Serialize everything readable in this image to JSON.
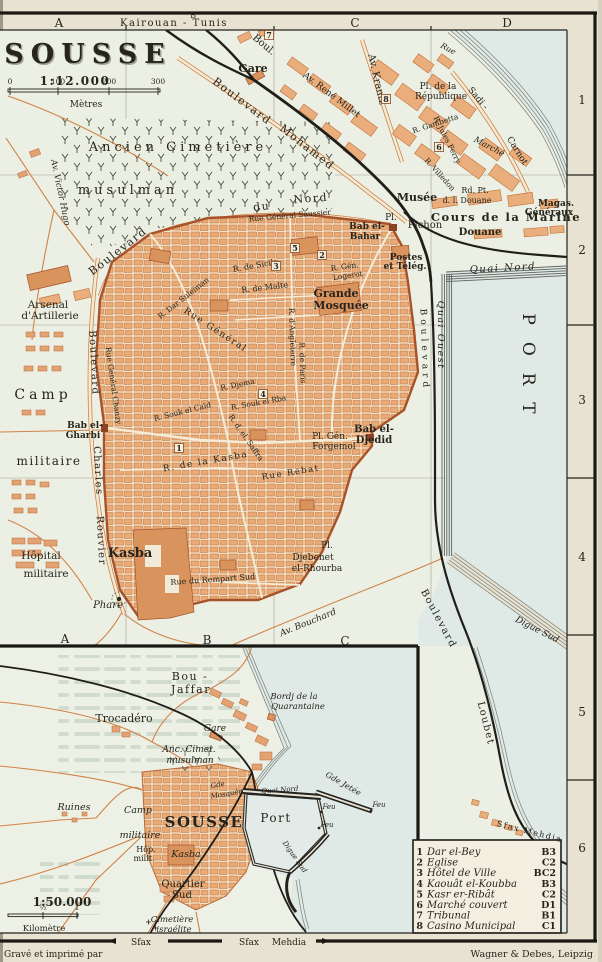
{
  "colors": {
    "paper": "#e7e2d1",
    "land": "#ecefe3",
    "water": "#dfe9e6",
    "town_salmon": "#e9ae7c",
    "wall_orange": "#a8522a",
    "ink": "#27241c",
    "bleed": "#9cb6a7"
  },
  "frame": {
    "destinations": {
      "t": "Kairouan - Tunis",
      "x": 174,
      "y": 26,
      "s": 10,
      "c": "sp1"
    },
    "cols_top": [
      {
        "t": "A",
        "x": 59,
        "y": 27,
        "s": 12
      },
      {
        "t": "B",
        "x": 193,
        "y": 18,
        "s": 8
      },
      {
        "t": "C",
        "x": 355,
        "y": 27,
        "s": 12
      },
      {
        "t": "D",
        "x": 507,
        "y": 27,
        "s": 12
      }
    ],
    "cols_bottom": [
      {
        "t": "A",
        "x": 65,
        "y": 643,
        "s": 12
      },
      {
        "t": "B",
        "x": 207,
        "y": 644,
        "s": 12
      },
      {
        "t": "C",
        "x": 345,
        "y": 645,
        "s": 12
      }
    ],
    "rows_right": [
      {
        "t": "1",
        "x": 582,
        "y": 104,
        "s": 12
      },
      {
        "t": "2",
        "x": 582,
        "y": 254,
        "s": 12
      },
      {
        "t": "3",
        "x": 582,
        "y": 404,
        "s": 12
      },
      {
        "t": "4",
        "x": 582,
        "y": 561,
        "s": 12
      },
      {
        "t": "5",
        "x": 582,
        "y": 716,
        "s": 12
      },
      {
        "t": "6",
        "x": 582,
        "y": 852,
        "s": 12
      }
    ]
  },
  "imprint": {
    "left": {
      "t": "Gravé et imprimé par",
      "x": 4,
      "y": 957,
      "s": 9,
      "a": "start"
    },
    "right": {
      "t": "Wagner & Debes, Leipzig",
      "x": 593,
      "y": 957,
      "s": 9.5,
      "a": "end"
    }
  },
  "bottom_edge": [
    {
      "t": "Sfax",
      "x": 141,
      "y": 945,
      "s": 9
    },
    {
      "t": "Sfax",
      "x": 249,
      "y": 945,
      "s": 9
    },
    {
      "t": "Mehdia",
      "x": 289,
      "y": 945,
      "s": 9
    }
  ],
  "main_map": {
    "scale_bar": {
      "x1": 8,
      "x2": 160,
      "y": 89,
      "unit": "Mètres",
      "ticks": [
        {
          "t": "0",
          "x": 10
        },
        {
          "t": "100",
          "x": 58
        },
        {
          "t": "200",
          "x": 109
        },
        {
          "t": "300",
          "x": 158
        }
      ]
    },
    "markers": [
      {
        "n": "1",
        "x": 179,
        "y": 450
      },
      {
        "n": "2",
        "x": 322,
        "y": 257
      },
      {
        "n": "3",
        "x": 276,
        "y": 268
      },
      {
        "n": "4",
        "x": 263,
        "y": 396
      },
      {
        "n": "5",
        "x": 295,
        "y": 250
      },
      {
        "n": "6",
        "x": 439,
        "y": 149
      },
      {
        "n": "7",
        "x": 269,
        "y": 37
      },
      {
        "n": "8",
        "x": 386,
        "y": 101
      }
    ],
    "labels": [
      {
        "t": "SOUSSE",
        "x": 88,
        "y": 63,
        "s": 27,
        "c": "sans ttl sh"
      },
      {
        "t": "1:12.000",
        "x": 75,
        "y": 85,
        "s": 12,
        "c": "sans b sp1"
      },
      {
        "t": "Mètres",
        "x": 86,
        "y": 107,
        "s": 9
      },
      {
        "t": "Boul.",
        "x": 262,
        "y": 47,
        "r": 40,
        "s": 10
      },
      {
        "t": "Gare",
        "x": 253,
        "y": 72,
        "s": 11,
        "c": "b"
      },
      {
        "t": "Boulevard",
        "x": 240,
        "y": 104,
        "r": 37,
        "s": 11,
        "c": "sp1"
      },
      {
        "t": "Mohamed",
        "x": 305,
        "y": 150,
        "r": 38,
        "s": 11,
        "c": "sp1"
      },
      {
        "t": "Av. René Millet",
        "x": 330,
        "y": 97,
        "r": 37,
        "s": 9
      },
      {
        "t": "Av. Krantz",
        "x": 374,
        "y": 80,
        "r": 77,
        "s": 10
      },
      {
        "t": "Rue",
        "x": 447,
        "y": 51,
        "r": 28,
        "s": 8,
        "c": "i"
      },
      {
        "t": "Pl. de la",
        "x": 438,
        "y": 89,
        "s": 9
      },
      {
        "t": "République",
        "x": 441,
        "y": 99,
        "s": 9
      },
      {
        "t": "Sadi -",
        "x": 476,
        "y": 100,
        "r": 50,
        "s": 9
      },
      {
        "t": "Carnot",
        "x": 515,
        "y": 152,
        "r": 58,
        "s": 9
      },
      {
        "t": "R. Gambetta",
        "x": 436,
        "y": 126,
        "r": -18,
        "s": 7.5
      },
      {
        "t": "R. Jules Ferry",
        "x": 445,
        "y": 141,
        "r": 63,
        "s": 7.5
      },
      {
        "t": "Marché",
        "x": 488,
        "y": 149,
        "r": 28,
        "s": 8.5,
        "c": "i"
      },
      {
        "t": "R. Villedon",
        "x": 438,
        "y": 176,
        "r": 48,
        "s": 7.5
      },
      {
        "t": "Musée",
        "x": 417,
        "y": 201,
        "s": 11,
        "c": "b"
      },
      {
        "t": "Rd. Pt.",
        "x": 475,
        "y": 193,
        "s": 8
      },
      {
        "t": "d. l. Douane",
        "x": 467,
        "y": 203,
        "s": 8
      },
      {
        "t": "Pl.",
        "x": 391,
        "y": 220,
        "s": 9
      },
      {
        "t": "Pichon",
        "x": 425,
        "y": 228,
        "s": 10
      },
      {
        "t": "Cours de la Marine",
        "x": 506,
        "y": 221,
        "s": 11.5,
        "c": "b sp1"
      },
      {
        "t": "Douane",
        "x": 480,
        "y": 235,
        "s": 10,
        "c": "b"
      },
      {
        "t": "Magas.",
        "x": 556,
        "y": 206,
        "s": 9,
        "c": "b"
      },
      {
        "t": "Généraux",
        "x": 549,
        "y": 215,
        "s": 9,
        "c": "b"
      },
      {
        "t": "Bab el-",
        "x": 367,
        "y": 229,
        "s": 9,
        "c": "b"
      },
      {
        "t": "Bahar",
        "x": 365,
        "y": 239,
        "s": 9,
        "c": "b"
      },
      {
        "t": "Postes",
        "x": 406,
        "y": 260,
        "s": 9,
        "c": "b"
      },
      {
        "t": "et Télég.",
        "x": 405,
        "y": 269,
        "s": 9,
        "c": "b"
      },
      {
        "t": "Quai Nord",
        "x": 503,
        "y": 271,
        "r": -3,
        "s": 10,
        "c": "i sp1"
      },
      {
        "t": "Quai Ouest",
        "x": 438,
        "y": 335,
        "r": 90,
        "s": 9.5,
        "c": "i sp1"
      },
      {
        "t": "PORT",
        "x": 523,
        "y": 372,
        "r": 90,
        "s": 17,
        "c": "sp3"
      },
      {
        "t": "Boulevard",
        "x": 422,
        "y": 350,
        "r": 88,
        "s": 9,
        "c": "sp2"
      },
      {
        "t": "Boulevard",
        "x": 436,
        "y": 620,
        "r": 62,
        "s": 10,
        "c": "sp1"
      },
      {
        "t": "Loubet",
        "x": 483,
        "y": 724,
        "r": 76,
        "s": 10,
        "c": "sp1"
      },
      {
        "t": "Digue Sud",
        "x": 536,
        "y": 632,
        "r": 27,
        "s": 9,
        "c": "i"
      },
      {
        "t": "Grande",
        "x": 336,
        "y": 297,
        "s": 11,
        "c": "b"
      },
      {
        "t": "Mosquée",
        "x": 341,
        "y": 309,
        "s": 11,
        "c": "b"
      },
      {
        "t": "R. Gén.",
        "x": 345,
        "y": 269,
        "r": -8,
        "s": 7.5
      },
      {
        "t": "Logerot",
        "x": 348,
        "y": 278,
        "r": -8,
        "s": 7.5
      },
      {
        "t": "Rue Général Saussier",
        "x": 290,
        "y": 218,
        "r": -5,
        "s": 7.5
      },
      {
        "t": "Boulevard",
        "x": 120,
        "y": 254,
        "r": -38,
        "s": 11,
        "c": "sp1"
      },
      {
        "t": "du",
        "x": 262,
        "y": 210,
        "r": -6,
        "s": 11,
        "c": "sp1"
      },
      {
        "t": "Nord",
        "x": 311,
        "y": 202,
        "r": -4,
        "s": 11,
        "c": "sp1"
      },
      {
        "t": "R. de Sicile",
        "x": 256,
        "y": 268,
        "r": -10,
        "s": 8
      },
      {
        "t": "R. de Malte",
        "x": 265,
        "y": 290,
        "r": -7,
        "s": 8
      },
      {
        "t": "R. Dar Suleïman",
        "x": 185,
        "y": 300,
        "r": -38,
        "s": 7.5
      },
      {
        "t": "Rue Général",
        "x": 214,
        "y": 332,
        "r": 33,
        "s": 9,
        "c": "sp1"
      },
      {
        "t": "Rue Général Chanzy",
        "x": 111,
        "y": 386,
        "r": 82,
        "s": 7.5
      },
      {
        "t": "R. d'Angleterre",
        "x": 290,
        "y": 337,
        "r": 88,
        "s": 7.5
      },
      {
        "t": "R. de Paris",
        "x": 300,
        "y": 363,
        "r": 88,
        "s": 7.5
      },
      {
        "t": "R. Djema",
        "x": 238,
        "y": 387,
        "r": -12,
        "s": 7.5
      },
      {
        "t": "R. Souk el Caïd",
        "x": 183,
        "y": 414,
        "r": -14,
        "s": 7.5
      },
      {
        "t": "R. Souk el Rba",
        "x": 259,
        "y": 405,
        "r": -10,
        "s": 7.5
      },
      {
        "t": "R. d. el. Saffra",
        "x": 244,
        "y": 439,
        "r": 55,
        "s": 7.5
      },
      {
        "t": "Pl. Gén.",
        "x": 330,
        "y": 439,
        "s": 9
      },
      {
        "t": "Forgemol",
        "x": 334,
        "y": 449,
        "s": 9
      },
      {
        "t": "Bab el-",
        "x": 374,
        "y": 432,
        "s": 10,
        "c": "b"
      },
      {
        "t": "Djedid",
        "x": 374,
        "y": 443,
        "s": 10,
        "c": "b"
      },
      {
        "t": "R. de la Kasba",
        "x": 206,
        "y": 464,
        "r": -10,
        "s": 9,
        "c": "sp1"
      },
      {
        "t": "Rue Rebat",
        "x": 291,
        "y": 475,
        "r": -9,
        "s": 8.5,
        "c": "sp1"
      },
      {
        "t": "Pl.",
        "x": 327,
        "y": 548,
        "s": 9
      },
      {
        "t": "Djebenet",
        "x": 313,
        "y": 560,
        "s": 9
      },
      {
        "t": "el-Rhourba",
        "x": 317,
        "y": 571,
        "s": 9
      },
      {
        "t": "Av. Bouchard",
        "x": 309,
        "y": 625,
        "r": -22,
        "s": 9,
        "c": "i"
      },
      {
        "t": "Rue du Rempart Sud",
        "x": 213,
        "y": 582,
        "r": -4,
        "s": 8
      },
      {
        "t": "Av. Victor Hugo",
        "x": 58,
        "y": 193,
        "r": 78,
        "s": 8.5,
        "c": "i"
      },
      {
        "t": "Arsenal",
        "x": 48,
        "y": 308,
        "s": 10.5
      },
      {
        "t": "d'Artillerie",
        "x": 50,
        "y": 319,
        "s": 10.5
      },
      {
        "t": "Boulevard",
        "x": 91,
        "y": 363,
        "r": 87,
        "s": 10,
        "c": "sp1"
      },
      {
        "t": "Charles",
        "x": 95,
        "y": 471,
        "r": 87,
        "s": 10,
        "c": "sp1"
      },
      {
        "t": "Rouvier",
        "x": 98,
        "y": 541,
        "r": 87,
        "s": 10,
        "c": "sp1"
      },
      {
        "t": "Camp",
        "x": 43,
        "y": 399,
        "s": 14,
        "c": "sp2"
      },
      {
        "t": "militaire",
        "x": 49,
        "y": 465,
        "s": 12,
        "c": "sp1"
      },
      {
        "t": "Bab el-",
        "x": 85,
        "y": 428,
        "s": 9,
        "c": "b"
      },
      {
        "t": "Gharbi",
        "x": 83,
        "y": 438,
        "s": 9,
        "c": "b"
      },
      {
        "t": "Hôpital",
        "x": 41,
        "y": 559,
        "s": 10.5
      },
      {
        "t": "militaire",
        "x": 46,
        "y": 577,
        "s": 10.5
      },
      {
        "t": "Kasba",
        "x": 130,
        "y": 557,
        "s": 13,
        "c": "b"
      },
      {
        "t": "Phare",
        "x": 108,
        "y": 608,
        "s": 10,
        "c": "i"
      },
      {
        "t": "Ancien Cimetière",
        "x": 178,
        "y": 151,
        "s": 13,
        "c": "sp2"
      },
      {
        "t": "musulman",
        "x": 128,
        "y": 194,
        "s": 13,
        "c": "sp2"
      },
      {
        "t": "Sfax Mehdia",
        "x": 529,
        "y": 834,
        "r": 14,
        "s": 8,
        "c": "sp1"
      }
    ]
  },
  "inset_map": {
    "scale_bar": {
      "x1": 8,
      "x2": 78,
      "y": 914,
      "unit": "Kilomètre",
      "ticks": [
        {
          "t": "½",
          "x": 43
        },
        {
          "t": "1",
          "x": 77
        }
      ]
    },
    "labels": [
      {
        "t": "Bou -",
        "x": 190,
        "y": 680,
        "s": 11,
        "c": "sp1"
      },
      {
        "t": "Jaffar",
        "x": 191,
        "y": 693,
        "s": 11,
        "c": "sp1"
      },
      {
        "t": "Trocadéro",
        "x": 124,
        "y": 722,
        "s": 11
      },
      {
        "t": "Gare",
        "x": 215,
        "y": 731,
        "s": 9,
        "c": "i"
      },
      {
        "t": "Bordj de la",
        "x": 294,
        "y": 699,
        "s": 8.5,
        "c": "i"
      },
      {
        "t": "Quarantaine",
        "x": 298,
        "y": 709,
        "s": 8.5,
        "c": "i"
      },
      {
        "t": "Anc. Cimet.",
        "x": 189,
        "y": 752,
        "s": 9,
        "c": "i"
      },
      {
        "t": "musulman",
        "x": 190,
        "y": 763,
        "s": 9,
        "c": "i"
      },
      {
        "t": "Ruines",
        "x": 74,
        "y": 810,
        "s": 9.5,
        "c": "i"
      },
      {
        "t": "Camp",
        "x": 138,
        "y": 813,
        "s": 9.5,
        "c": "i"
      },
      {
        "t": "militaire",
        "x": 140,
        "y": 838,
        "s": 9.5,
        "c": "i"
      },
      {
        "t": "SOUSSE",
        "x": 204,
        "y": 827,
        "s": 15,
        "c": "b sp1"
      },
      {
        "t": "Gde",
        "x": 218,
        "y": 787,
        "r": -10,
        "s": 7,
        "c": "i"
      },
      {
        "t": "Mosquée",
        "x": 227,
        "y": 796,
        "r": -10,
        "s": 7,
        "c": "i"
      },
      {
        "t": "Hôp.",
        "x": 146,
        "y": 852,
        "s": 8
      },
      {
        "t": "milit.",
        "x": 144,
        "y": 861,
        "s": 8
      },
      {
        "t": "Kasba",
        "x": 186,
        "y": 857,
        "s": 9.5,
        "c": "i"
      },
      {
        "t": "Quartier",
        "x": 183,
        "y": 887,
        "s": 10
      },
      {
        "t": "Sud",
        "x": 182,
        "y": 898,
        "s": 10
      },
      {
        "t": "Cimetière",
        "x": 172,
        "y": 922,
        "s": 8.5,
        "c": "i"
      },
      {
        "t": "israélite",
        "x": 174,
        "y": 932,
        "s": 8.5,
        "c": "i"
      },
      {
        "t": "1:50.000",
        "x": 62,
        "y": 906,
        "s": 12,
        "c": "sans b"
      },
      {
        "t": "Kilomètre",
        "x": 44,
        "y": 931,
        "s": 8.5
      },
      {
        "t": "Port",
        "x": 276,
        "y": 822,
        "s": 12,
        "c": "sp1"
      },
      {
        "t": "Quai Nord",
        "x": 280,
        "y": 792,
        "r": -4,
        "s": 7,
        "c": "i wt"
      },
      {
        "t": "Digue Sud",
        "x": 293,
        "y": 858,
        "r": 55,
        "s": 7,
        "c": "i wt"
      },
      {
        "t": "Gde Jetée",
        "x": 342,
        "y": 786,
        "r": 30,
        "s": 8,
        "c": "i"
      },
      {
        "t": "Feu",
        "x": 329,
        "y": 809,
        "s": 7,
        "c": "i"
      },
      {
        "t": "Feu",
        "x": 327,
        "y": 827,
        "s": 7,
        "c": "i"
      },
      {
        "t": "Feu",
        "x": 379,
        "y": 807,
        "s": 7,
        "c": "i"
      }
    ]
  },
  "legend": {
    "items": [
      {
        "num": "1",
        "name": "Dar el-Bey",
        "ref": "B3"
      },
      {
        "num": "2",
        "name": "Eglise",
        "ref": "C2"
      },
      {
        "num": "3",
        "name": "Hôtel de Ville",
        "ref": "BC2"
      },
      {
        "num": "4",
        "name": "Kaouât el-Koubba",
        "ref": "B3"
      },
      {
        "num": "5",
        "name": "Kasr er-Ribât",
        "ref": "C2"
      },
      {
        "num": "6",
        "name": "Marché couvert",
        "ref": "D1"
      },
      {
        "num": "7",
        "name": "Tribunal",
        "ref": "B1"
      },
      {
        "num": "8",
        "name": "Casino Municipal",
        "ref": "C1"
      }
    ]
  }
}
